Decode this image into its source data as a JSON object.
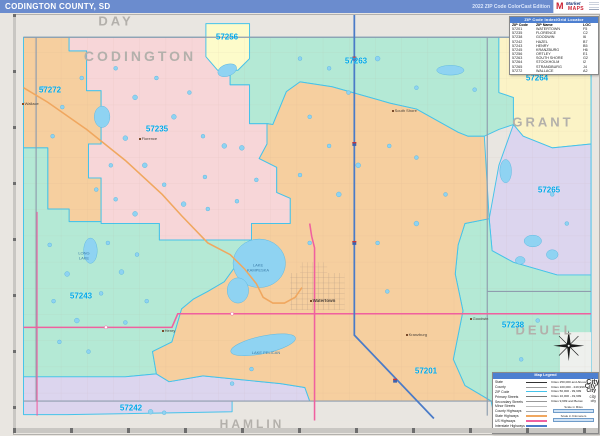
{
  "header": {
    "title": "CODINGTON COUNTY, SD",
    "edition": "2022 ZIP Code ColorCast Edition",
    "logo": {
      "mark": "M",
      "line1": "Market",
      "line2": "MAPS"
    }
  },
  "index_table": {
    "title": "ZIP Code Index/Grid Locator",
    "columns": [
      "ZIP Code",
      "ZIP Name",
      "LOC"
    ],
    "rows": [
      {
        "zip": "57201",
        "name": "WATERTOWN",
        "loc": "F5"
      },
      {
        "zip": "57235",
        "name": "FLORENCE",
        "loc": "C2"
      },
      {
        "zip": "57238",
        "name": "GOODWIN",
        "loc": "I6"
      },
      {
        "zip": "57242",
        "name": "HAZEL",
        "loc": "B7"
      },
      {
        "zip": "57243",
        "name": "HENRY",
        "loc": "B5"
      },
      {
        "zip": "57245",
        "name": "KRANZBURG",
        "loc": "H6"
      },
      {
        "zip": "57256",
        "name": "ORTLEY",
        "loc": "E1"
      },
      {
        "zip": "57263",
        "name": "SOUTH SHORE",
        "loc": "G2"
      },
      {
        "zip": "57264",
        "name": "STOCKHOLM",
        "loc": "I2"
      },
      {
        "zip": "57265",
        "name": "STRANDBURG",
        "loc": "J4"
      },
      {
        "zip": "57272",
        "name": "WALLACE",
        "loc": "A2"
      }
    ]
  },
  "map": {
    "county_labels": [
      "DAY",
      "CODINGTON",
      "GRANT",
      "DEUEL",
      "HAMLIN"
    ],
    "zip_labels": [
      "57256",
      "57272",
      "57235",
      "57263",
      "57264",
      "57265",
      "57243",
      "57201",
      "57238",
      "57242"
    ],
    "towns": [
      "Watertown",
      "Florence",
      "Wallace",
      "South Shore",
      "Goodwin",
      "Kranzburg",
      "Henry"
    ],
    "lakes": [
      "LAKE\nKAMPESKA",
      "LONG\nLAKE",
      "LAKE PELICAN"
    ],
    "colors": {
      "zip_label": "#00a8e8",
      "county_label": "#b3b0ab",
      "zip_boundary": "#45c3ea",
      "county_line": "#8f9dae",
      "lake": "#8fd3f2",
      "interstate": "#4a7bc8",
      "us_highway": "#f0609f",
      "state_highway": "#f0a75f",
      "region_pink": "#f7d6d8",
      "region_orange": "#f6cf9f",
      "region_mint": "#b4e9d5",
      "region_yellow": "#fbf3c6",
      "region_lavender": "#dcd5ee"
    }
  },
  "legend": {
    "title": "Map Legend",
    "items": [
      "State",
      "County",
      "ZIP Code",
      "Primary Streets",
      "Secondary Streets",
      "Minor Streets",
      "County Highways",
      "State Highways",
      "US Highways",
      "Interstate Highways",
      "Toll Roads"
    ],
    "cities": [
      {
        "label": "Cities 250,000 and Above",
        "sample": "City"
      },
      {
        "label": "Cities 100,000 - 249,999",
        "sample": "City"
      },
      {
        "label": "Cities 50,000 - 99,999",
        "sample": "City"
      },
      {
        "label": "Cities 10,000 - 49,999",
        "sample": "city"
      },
      {
        "label": "Cities 9,999 and Below",
        "sample": "city"
      }
    ],
    "scales": [
      "Scale in Miles",
      "Scale in Kilometers"
    ]
  }
}
